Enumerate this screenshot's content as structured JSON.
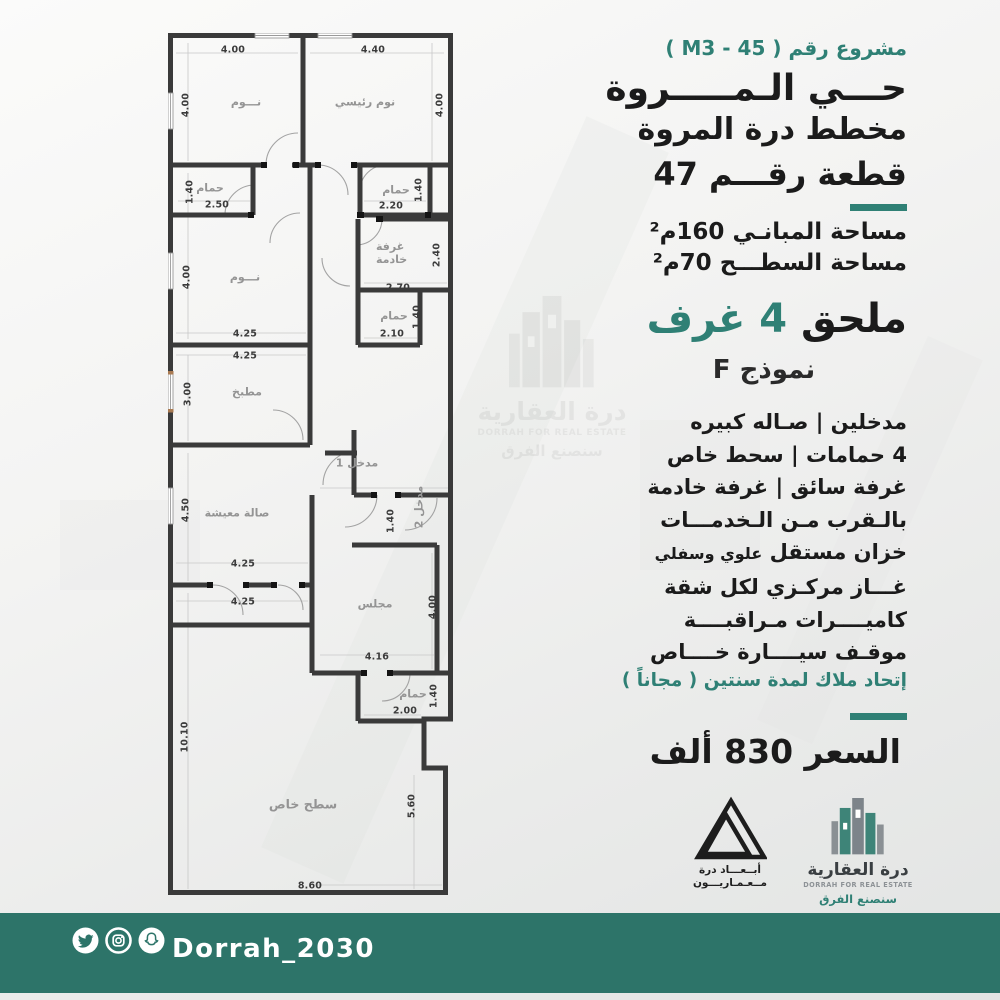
{
  "colors": {
    "accent": "#2f8075",
    "footer_bar": "#2d7469",
    "wall": "#3a3a3a"
  },
  "header": {
    "project": "مشروع رقم ( M3 - 45 )",
    "district": "حـــي الـمـــــروة",
    "plan_name": "مخطط درة المروة",
    "plot": "قطعة رقـــم 47"
  },
  "areas": {
    "built": "مساحة المبانـي 160م²",
    "roof": "مساحة السطـــح 70م²"
  },
  "annex": {
    "label": "ملحق",
    "value": "4 غرف"
  },
  "model": "نموذج F",
  "features": [
    "مدخلين   |   صـاله كبيره",
    "4 حمامات  |  سحط خاص",
    "غرفة سائق  |  غرفة خادمة",
    "بالـقرب مـن الـخدمـــات"
  ],
  "tank": {
    "main": "خزان مستقل",
    "sub": "علوي وسفلي"
  },
  "features2": [
    "غـــاز مركـزي لكل شقة",
    "كاميــــرات مـراقبــــة",
    "موقـف سيــــارة خــــاص"
  ],
  "union_note": "إتحاد ملاك لمدة سنتين ( مجاناً )",
  "price": "السعر  830  ألف",
  "logos": {
    "abaad": {
      "line1": "أبــعـــاد درة",
      "line2": "مــعـمـاريـــون"
    },
    "dorrah": {
      "name_ar": "درة العقارية",
      "name_en": "DORRAH FOR REAL ESTATE",
      "slogan": "سنصنع الفرق"
    }
  },
  "footer": {
    "handle": "Dorrah_2030",
    "icons": [
      "twitter-icon",
      "instagram-icon",
      "snapchat-icon"
    ]
  },
  "plan": {
    "rooms": {
      "bed1": {
        "name": "نـــوم",
        "w": "4.00",
        "h": "4.00"
      },
      "master": {
        "name": "نوم رئيسي",
        "w": "4.40",
        "h": "4.00"
      },
      "bath1": {
        "name": "حمام",
        "w": "2.50",
        "h": "1.40"
      },
      "bath2": {
        "name": "حمام",
        "w": "2.20",
        "h": "1.40"
      },
      "bed2": {
        "name": "نـــوم",
        "w": "4.25",
        "h": "4.00"
      },
      "maid": {
        "name": "غرفة خادمة",
        "w": "2.70",
        "h": "2.40"
      },
      "bath3": {
        "name": "حمام",
        "w": "2.10",
        "h": "1.40"
      },
      "kitchen": {
        "name": "مطبخ",
        "w": "4.25",
        "h": "3.00"
      },
      "living": {
        "name": "صالة معيشة",
        "w": "4.25",
        "w2": "4.25",
        "h": "4.50"
      },
      "entrance1": {
        "name": "مدخل 1"
      },
      "entrance2": {
        "name": "مدخل 2",
        "h": "1.40"
      },
      "majlis": {
        "name": "مجلس",
        "w": "4.16",
        "h": "4.00"
      },
      "bath4": {
        "name": "حمام",
        "w": "2.00",
        "h": "1.40"
      },
      "roof": {
        "name": "سطح خاص",
        "w": "8.60",
        "h": "10.10",
        "h2": "5.60"
      }
    }
  }
}
